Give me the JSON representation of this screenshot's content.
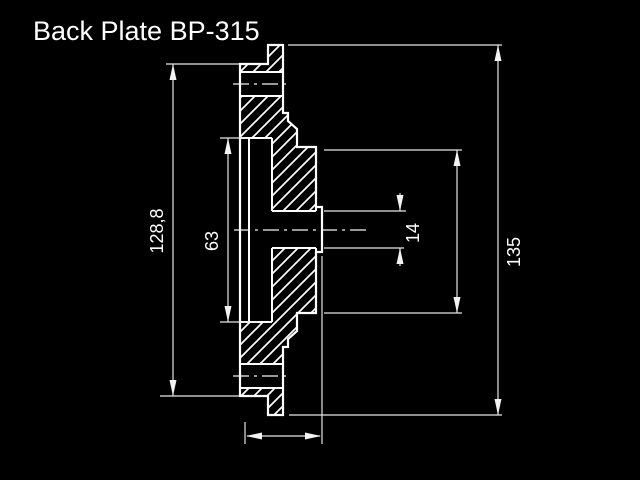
{
  "title": "Back Plate BP-315",
  "colors": {
    "background": "#000000",
    "part_outline": "#ffffff",
    "dimension_lines": "#e6e6e6",
    "text": "#ffffff"
  },
  "drawing": {
    "view": "cross-section with 45-degree hatching, dash-dot centerlines",
    "dimensions": {
      "rim_step_height": {
        "label": "128,8",
        "orientation": "vertical",
        "side": "left"
      },
      "recess_diameter": {
        "label": "63",
        "orientation": "vertical",
        "side": "left-inner"
      },
      "bore_diameter": {
        "label": "14",
        "orientation": "vertical",
        "side": "center-right"
      },
      "overall_diameter": {
        "label": "135",
        "orientation": "vertical",
        "side": "right"
      },
      "unlabeled_right_dim": {
        "label": "",
        "orientation": "vertical",
        "side": "right-inner"
      },
      "unlabeled_bottom_dim": {
        "label": "",
        "orientation": "horizontal",
        "side": "bottom"
      }
    }
  }
}
